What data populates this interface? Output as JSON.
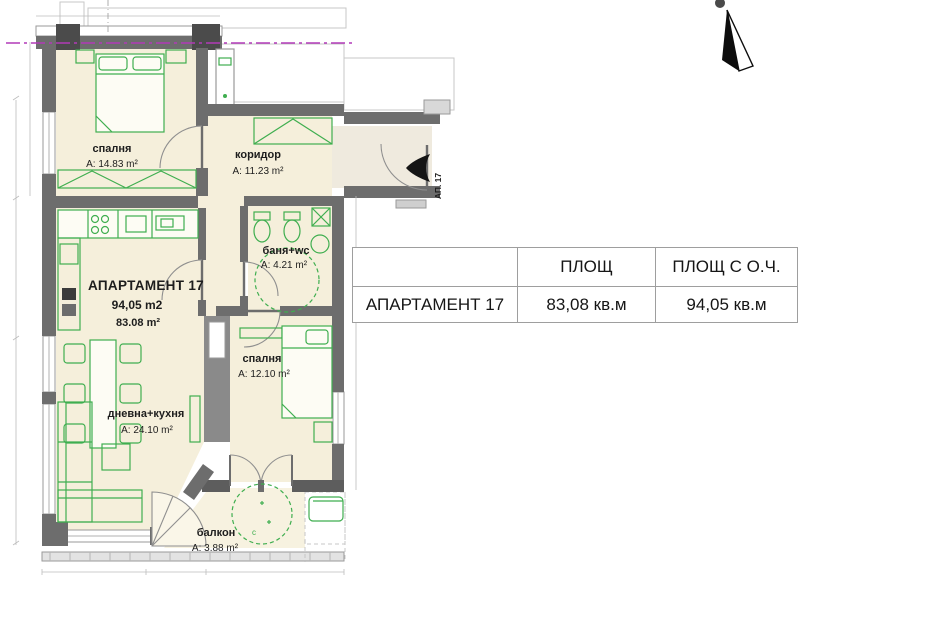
{
  "plan": {
    "rooms": [
      {
        "name": "спалня",
        "area": "A: 14.83 m²"
      },
      {
        "name": "коридор",
        "area": "A: 11.23 m²"
      },
      {
        "name": "баня+wc",
        "area": "A: 4.21 m²"
      },
      {
        "name": "спалня",
        "area": "A: 12.10 m²"
      },
      {
        "name": "дневна+кухня",
        "area": "A: 24.10 m²"
      },
      {
        "name": "балкон",
        "area": "A: 3.88 m²"
      }
    ],
    "apartment": {
      "title": "АПАРТАМЕНТ 17",
      "area_with_common": "94,05 m2",
      "area_net": "83.08 m²"
    },
    "entrance_label": "АП. 17",
    "balcony_mark": "c"
  },
  "table": {
    "headers": [
      "",
      "ПЛОЩ",
      "ПЛОЩ С О.Ч."
    ],
    "row": {
      "name": "АПАРТАМЕНТ 17",
      "area": "83,08 кв.м",
      "area_with_common": "94,05 кв.м"
    }
  },
  "icons": {
    "north_arrow": "➤ (black sail triangle pointing up)",
    "entrance_arrow": "◀"
  },
  "colors": {
    "floor_fill": "#f5efdb",
    "wall_dark": "#6d6d6d",
    "wall_pillar": "#4b4b4b",
    "furniture_green": "#3fae4f",
    "section_line_magenta": "#b23ab8",
    "table_border": "#9e9e9e",
    "text": "#1d1d1d"
  }
}
